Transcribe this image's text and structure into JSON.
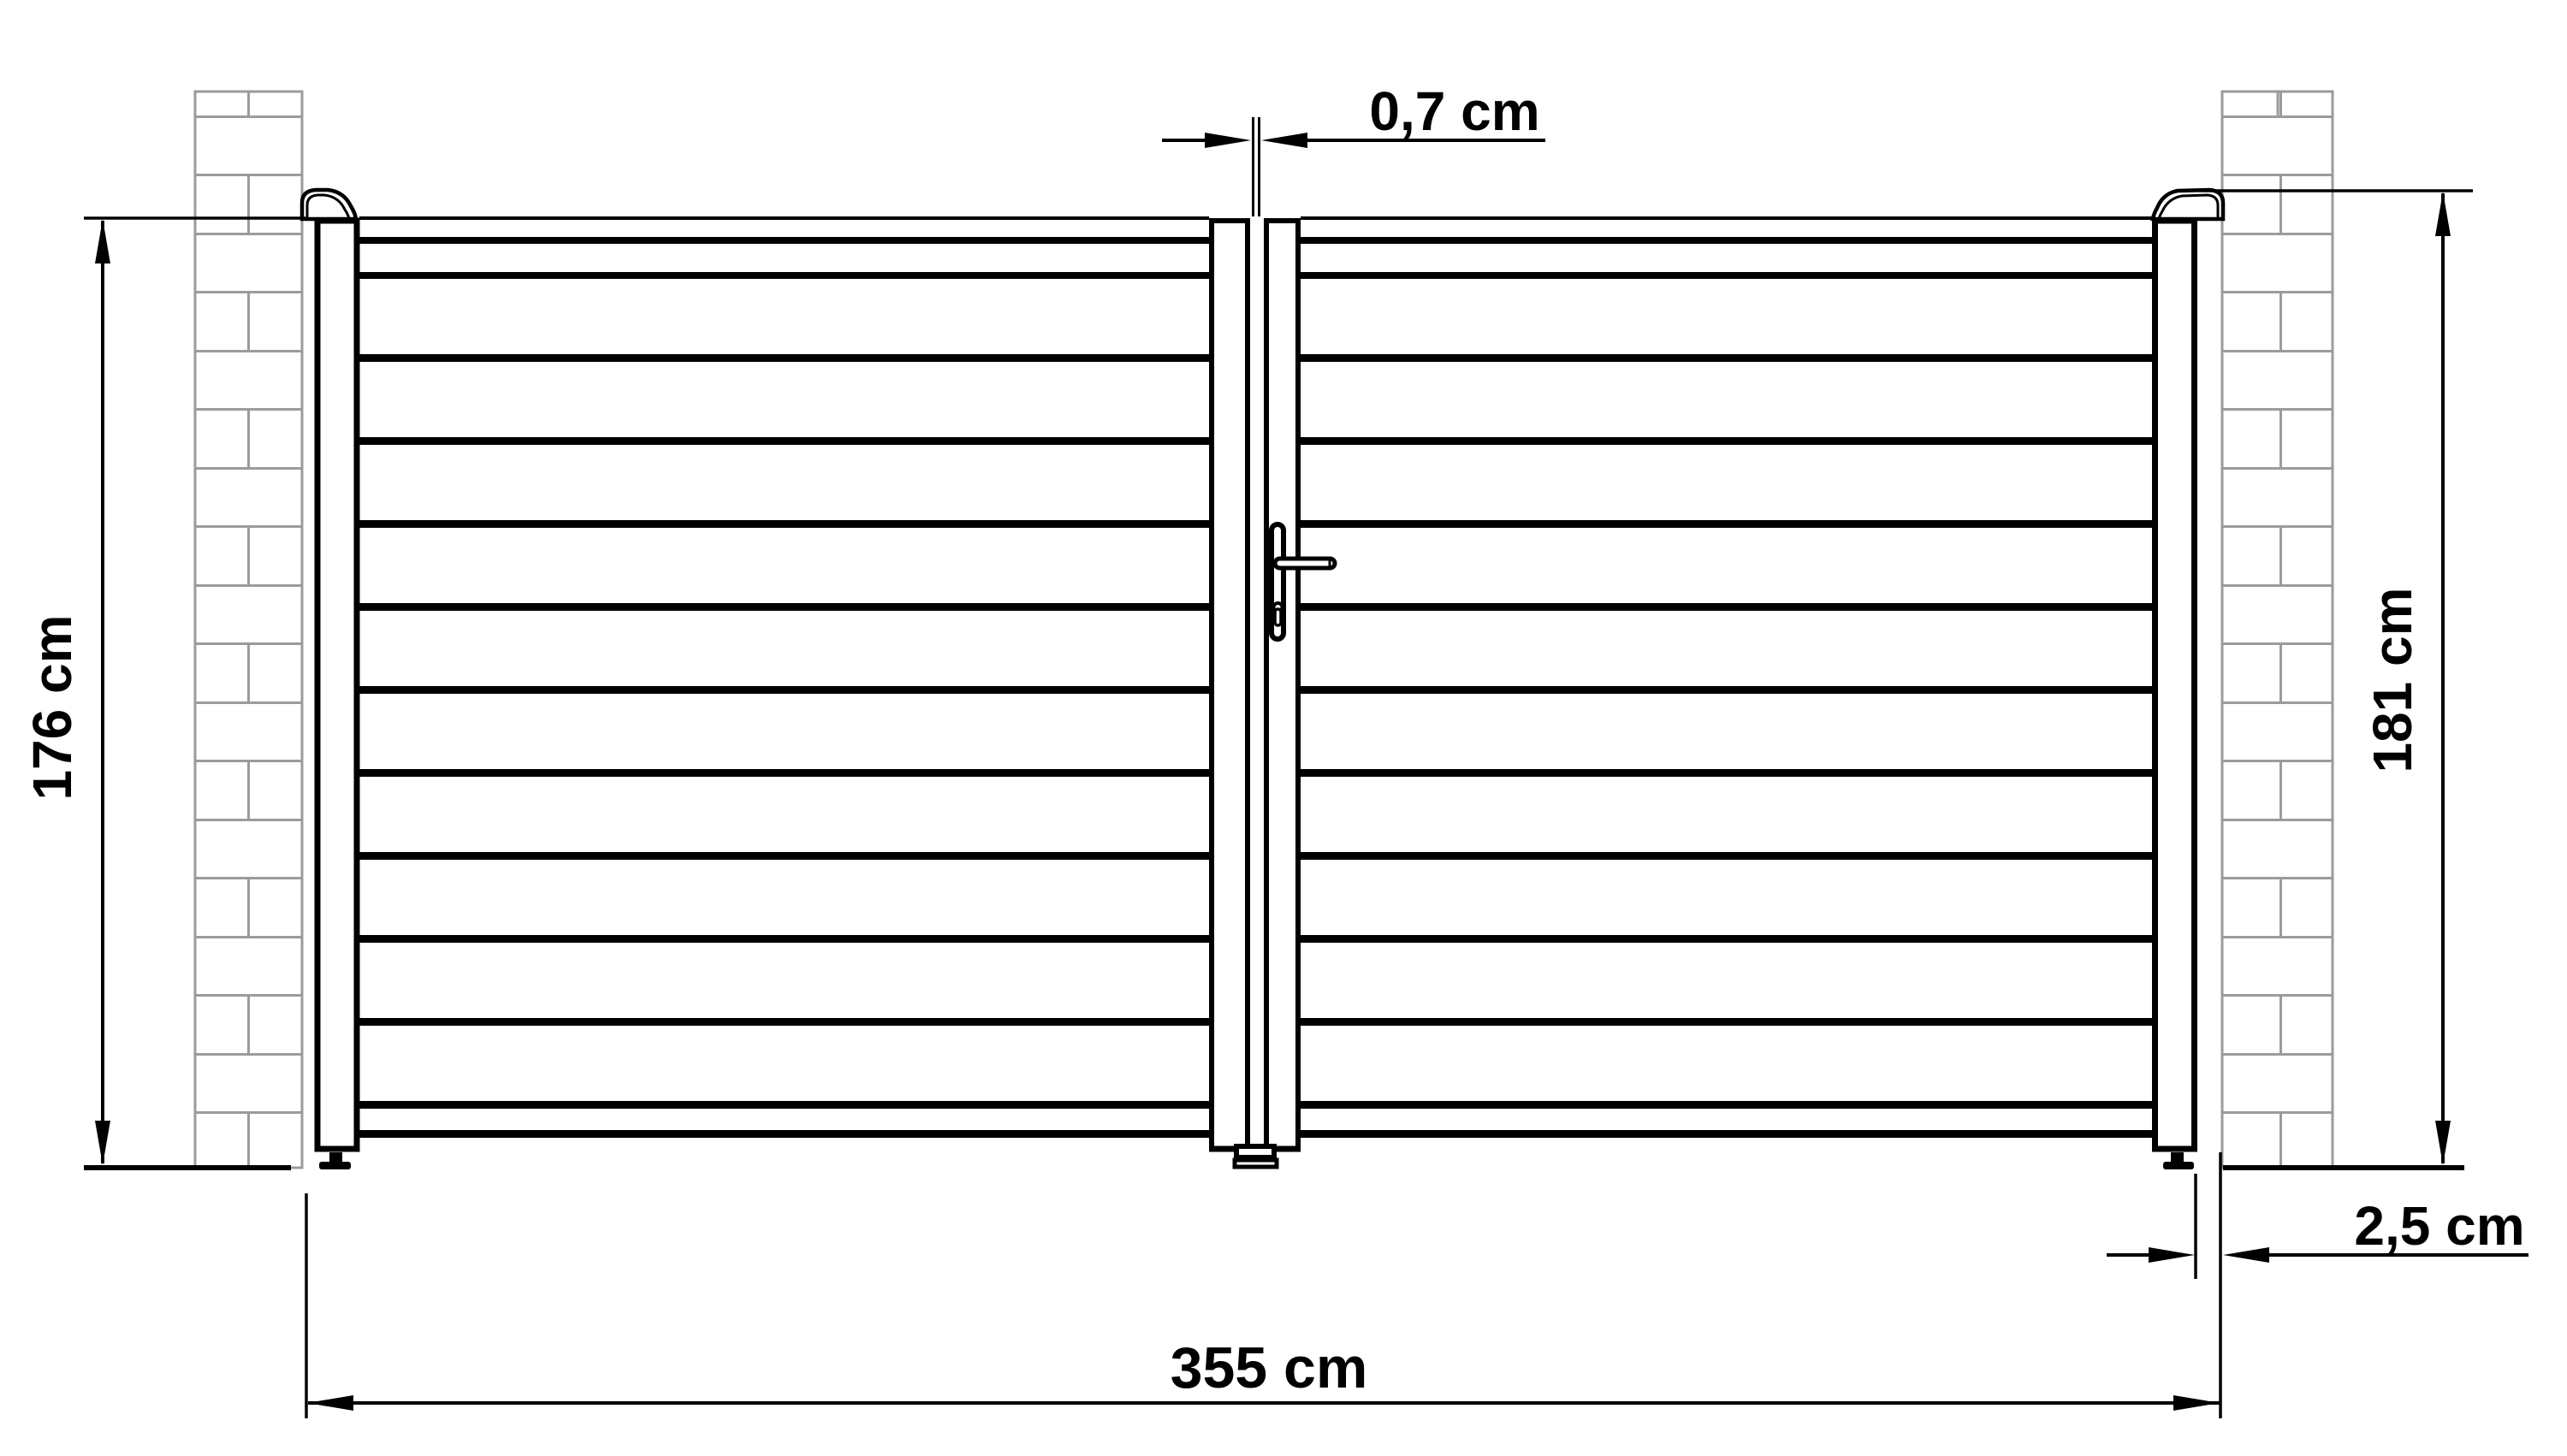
{
  "drawing": {
    "dimensions": {
      "center_gap": "0,7 cm",
      "gate_height_left": "176 cm",
      "post_height_right": "181 cm",
      "total_width": "355 cm",
      "side_clearance": "2,5 cm"
    },
    "colors": {
      "line": "#000000",
      "brick_joint": "#9b9b9b",
      "background": "#ffffff"
    }
  }
}
